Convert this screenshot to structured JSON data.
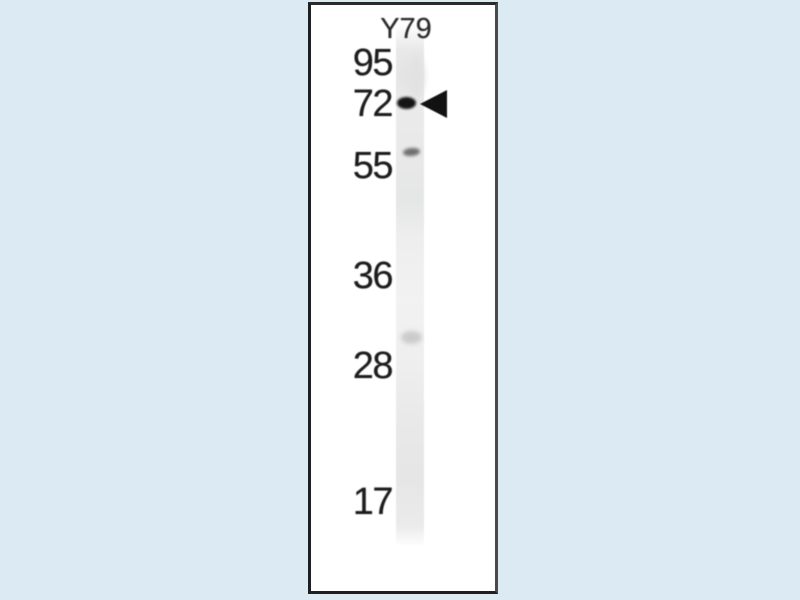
{
  "blot": {
    "lane_label": "Y79",
    "markers": [
      "95",
      "72",
      "55",
      "36",
      "28",
      "17"
    ],
    "bands": [
      {
        "name": "main-band",
        "approx_position_kda": 72,
        "intensity": "strong",
        "marked_by_arrowhead": true
      },
      {
        "name": "faint-band-upper",
        "approx_position_kda": 56,
        "intensity": "faint",
        "marked_by_arrowhead": false
      },
      {
        "name": "faint-band-lower",
        "approx_position_kda": 30,
        "intensity": "very faint",
        "marked_by_arrowhead": false
      }
    ],
    "colors": {
      "page_background": "#dceaf4",
      "panel_background": "#ffffff",
      "panel_border": "#1f1f1f",
      "lane_gray": "#e9e9e9",
      "band_dark": "#141414",
      "text": "#1d1d1d"
    }
  }
}
